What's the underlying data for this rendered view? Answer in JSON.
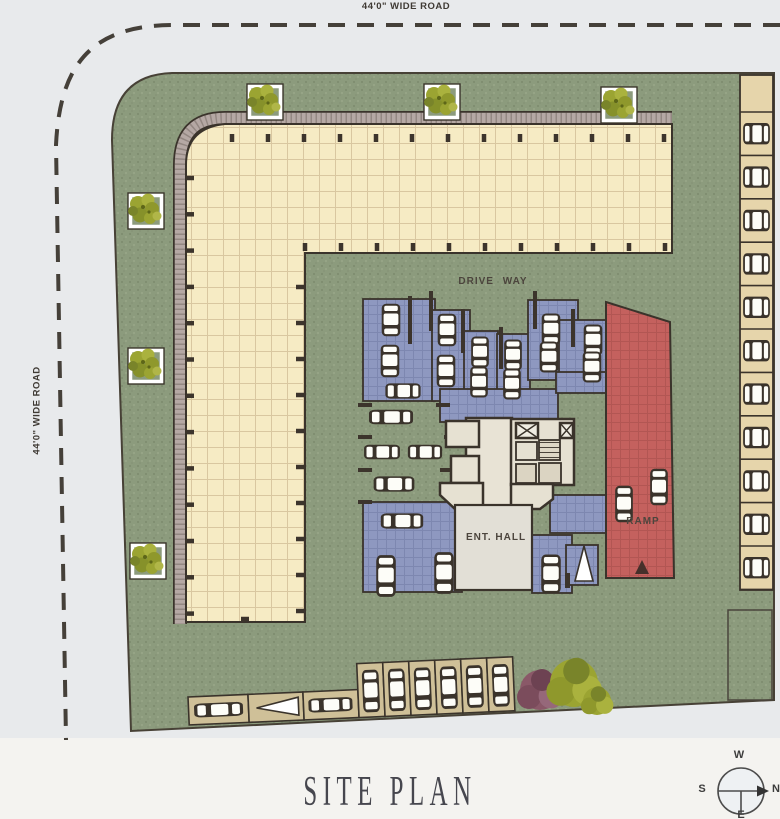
{
  "page": {
    "title_label": "SITE PLAN"
  },
  "roads": {
    "top_label": "44'0\" WIDE ROAD",
    "left_label": "44'0\" WIDE ROAD"
  },
  "plan_labels": {
    "driveway": "DRIVE WAY",
    "entrance_hall": "ENT. HALL",
    "ramp": "RAMP"
  },
  "compass": {
    "top": "W",
    "left": "S",
    "right": "N",
    "bottom": "E"
  },
  "colors": {
    "road_bg": "#e8eaec",
    "paper_bg": "#f4f3f0",
    "grass": "#8c9b7d",
    "podium": "#f6ebc4",
    "podium_grid": "#d9c7a0",
    "podium_band": "#b5a8a4",
    "parking_blue": "#8e98c0",
    "parking_blue_grid": "#7d87b0",
    "ramp_red": "#c4615e",
    "ramp_red_grid": "#b25653",
    "stall_tan": "#e6d5ab",
    "stall_row_tan": "#cfc098",
    "ink": "#3a332b",
    "car_body": "#fdfdf8",
    "tree_green": "#9ba432",
    "bush_purple": "#8a5868",
    "label_color": "#4c453d",
    "title_color": "#46464e"
  }
}
